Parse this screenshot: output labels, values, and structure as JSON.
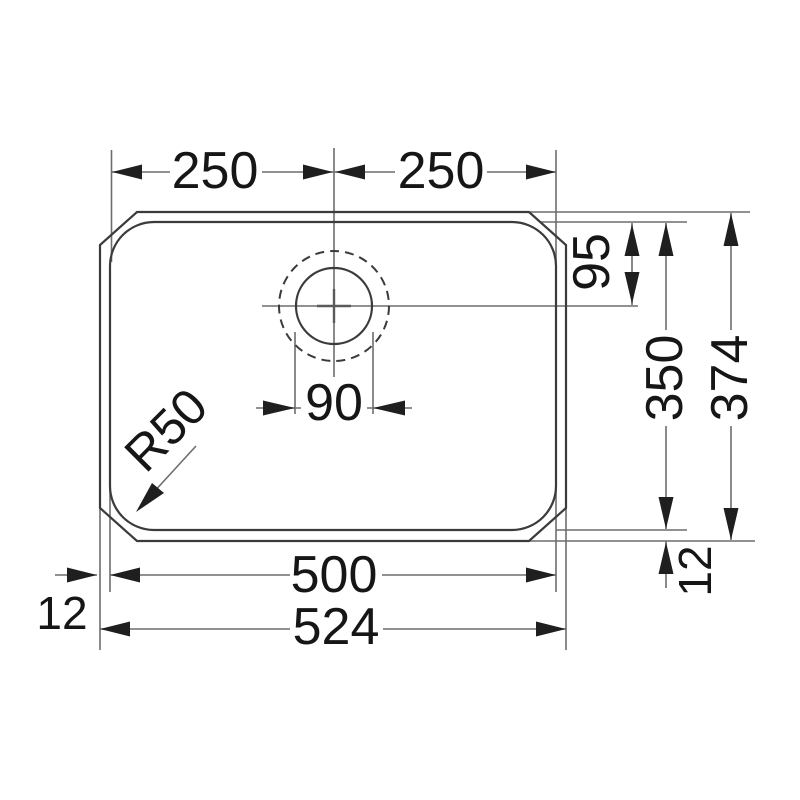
{
  "drawing": {
    "kind": "sink-dimension-diagram",
    "labels": {
      "top_left": "250",
      "top_right": "250",
      "drain_offset": "95",
      "bowl_height": "350",
      "overall_height": "374",
      "drain_diameter": "90",
      "corner_radius": "R50",
      "bowl_width": "500",
      "overall_width": "524",
      "rim_left": "12",
      "rim_right": "12"
    },
    "colors": {
      "background": "#ffffff",
      "outline": "#3b3b3b",
      "dimension_line": "#6d6d6d",
      "arrow": "#1f1f1f",
      "text": "#161616"
    }
  }
}
